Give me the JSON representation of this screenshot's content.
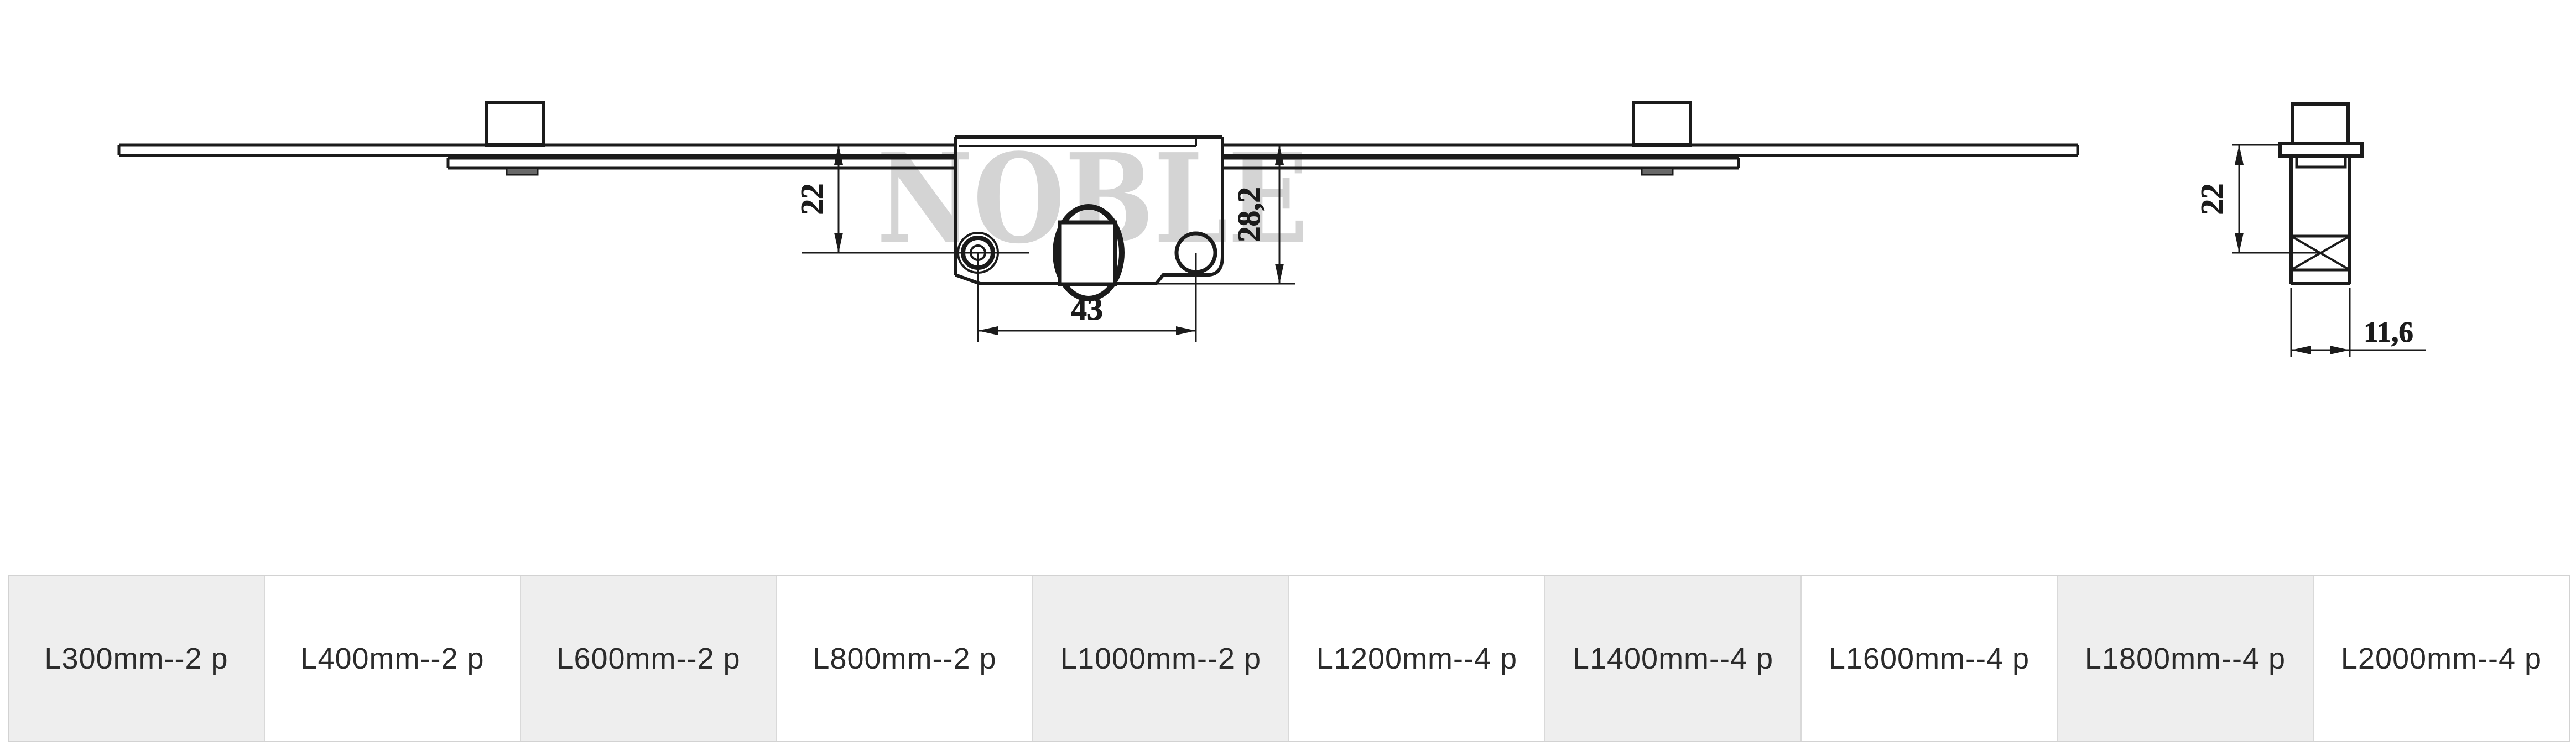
{
  "watermark": "NOBLE",
  "colors": {
    "line": "#1b1b1b",
    "watermark": "#d4d4d4",
    "table_alt_bg": "#eeeeee",
    "table_bg": "#ffffff",
    "table_border": "#d9d9d9",
    "table_text": "#2b2b2b",
    "background": "#ffffff"
  },
  "drawing": {
    "front_view": {
      "dim_backset": "22",
      "dim_body_height": "28,2",
      "dim_hole_spacing": "43"
    },
    "side_view": {
      "dim_backset": "22",
      "dim_body_width": "11,6"
    }
  },
  "size_table": {
    "cells": [
      {
        "label": "L300mm--2 p"
      },
      {
        "label": "L400mm--2 p"
      },
      {
        "label": "L600mm--2 p"
      },
      {
        "label": "L800mm--2 p"
      },
      {
        "label": "L1000mm--2 p"
      },
      {
        "label": "L1200mm--4 p"
      },
      {
        "label": "L1400mm--4 p"
      },
      {
        "label": "L1600mm--4 p"
      },
      {
        "label": "L1800mm--4 p"
      },
      {
        "label": "L2000mm--4 p"
      }
    ]
  }
}
